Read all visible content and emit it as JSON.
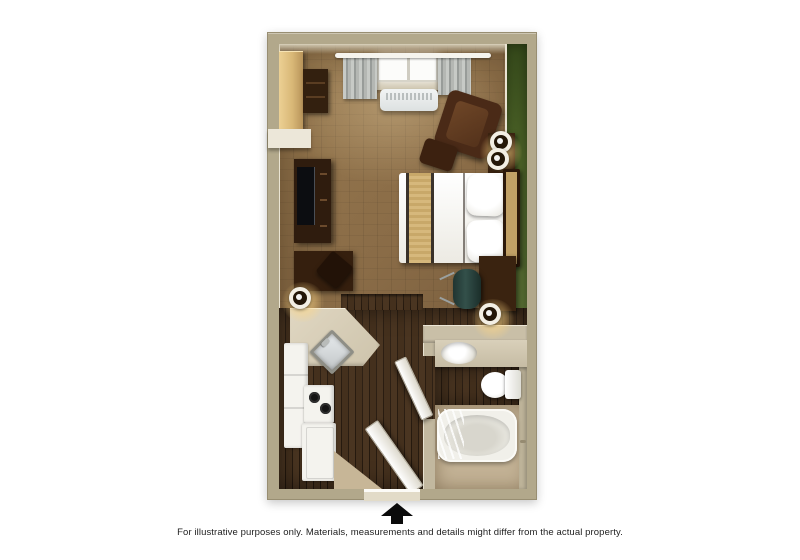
{
  "caption": "For illustrative purposes only.  Materials, measurements and details might differ from the actual property.",
  "plan": {
    "type": "studio-hotel-suite-floor-plan",
    "rooms": [
      "main-room",
      "kitchen",
      "entry",
      "bathroom"
    ],
    "furniture_icons": [
      "wardrobe-icon",
      "shelf-unit-icon",
      "curtain-rod-icon",
      "curtains-icon",
      "window-icon",
      "ac-unit-icon",
      "armchair-icon",
      "ottoman-icon",
      "side-table-icon",
      "table-lamp-icon",
      "bed-icon",
      "headboard-icon",
      "pillow-icon",
      "bed-runner-icon",
      "tv-console-icon",
      "tv-icon",
      "desk-icon",
      "desk-chair-icon",
      "desk-lamp-icon",
      "office-chair-icon",
      "nightstand-icon",
      "nightstand-lamp-icon",
      "kitchen-counter-icon",
      "kitchen-sink-icon",
      "refrigerator-icon",
      "stove-icon",
      "dishwasher-icon",
      "entry-door-icon",
      "bathroom-door-icon",
      "vanity-icon",
      "bathroom-sink-icon",
      "toilet-icon",
      "bathtub-icon",
      "shower-curtain-icon",
      "entrance-arrow-icon"
    ],
    "colors": {
      "background": "#ffffff",
      "exterior_wall": "#b2a88b",
      "interior_wall": "#c9bfa7",
      "accent_wall_green": "#4d6428",
      "parquet_floor": "#8a6c47",
      "walnut_floor": "#3f2c1b",
      "bathroom_tile": "#c3b295",
      "counter": "#d6ccb6",
      "fixture_white": "#f4f3ee",
      "furniture_dark_wood": "#3a2310",
      "arrow": "#0a0a0a",
      "caption_text": "#1e1e1e"
    }
  }
}
